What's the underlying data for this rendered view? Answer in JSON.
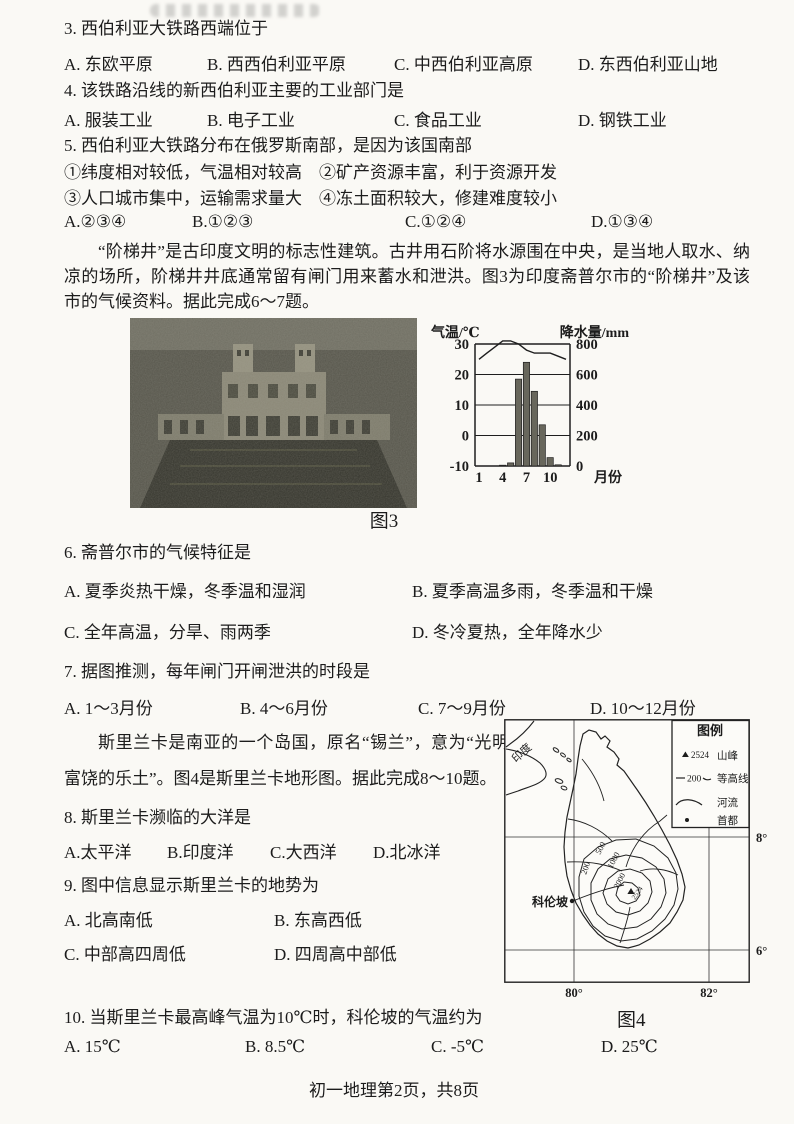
{
  "page": {
    "footer": "初一地理第2页，共8页"
  },
  "q3": {
    "stem": "3. 西伯利亚大铁路西端位于",
    "options": [
      "A. 东欧平原",
      "B. 西西伯利亚平原",
      "C. 中西伯利亚高原",
      "D. 东西伯利亚山地"
    ]
  },
  "q4": {
    "stem": "4. 该铁路沿线的新西伯利亚主要的工业部门是",
    "options": [
      "A. 服装工业",
      "B. 电子工业",
      "C. 食品工业",
      "D. 钢铁工业"
    ]
  },
  "q5": {
    "stem": "5. 西伯利亚大铁路分布在俄罗斯南部，是因为该国南部",
    "line1": "①纬度相对较低，气温相对较高　②矿产资源丰富，利于资源开发",
    "line2": "③人口城市集中，运输需求量大　④冻土面积较大，修建难度较小",
    "options": [
      "A.②③④",
      "B.①②③",
      "C.①②④",
      "D.①③④"
    ]
  },
  "passage1": "“阶梯井”是古印度文明的标志性建筑。古井用石阶将水源围在中央，是当地人取水、纳凉的场所，阶梯井井底通常留有闸门用来蓄水和泄洪。图3为印度斋普尔市的“阶梯井”及该市的气候资料。据此完成6～7题。",
  "figure3": {
    "caption": "图3"
  },
  "q6": {
    "stem": "6. 斋普尔市的气候特征是",
    "options": [
      "A. 夏季炎热干燥，冬季温和湿润",
      "B. 夏季高温多雨，冬季温和干燥",
      "C. 全年高温，分旱、雨两季",
      "D. 冬冷夏热，全年降水少"
    ]
  },
  "q7": {
    "stem": "7. 据图推测，每年闸门开闸泄洪的时段是",
    "options": [
      "A. 1～3月份",
      "B. 4～6月份",
      "C. 7～9月份",
      "D. 10～12月份"
    ]
  },
  "passage2": "斯里兰卡是南亚的一个岛国，原名“锡兰”，意为“光明富饶的乐土”。图4是斯里兰卡地形图。据此完成8～10题。",
  "q8": {
    "stem": "8. 斯里兰卡濒临的大洋是",
    "options": [
      "A.太平洋",
      "B.印度洋",
      "C.大西洋",
      "D.北冰洋"
    ]
  },
  "q9": {
    "stem": "9. 图中信息显示斯里兰卡的地势为",
    "options": [
      "A. 北高南低",
      "B. 东高西低",
      "C. 中部高四周低",
      "D. 四周高中部低"
    ]
  },
  "q10": {
    "stem": "10. 当斯里兰卡最高峰气温为10℃时，科伦坡的气温约为",
    "options": [
      "A. 15℃",
      "B. 8.5℃",
      "C. -5℃",
      "D. 25℃"
    ]
  },
  "figure4": {
    "caption": "图4",
    "legend": {
      "title": "图例",
      "peak_value": "2524",
      "peak_label": "山峰",
      "contour_value": "200",
      "contour_label": "等高线",
      "river_label": "河流",
      "capital_label": "首都"
    },
    "country_label": "印度",
    "capital_name": "科伦坡",
    "contour_labels": [
      "200",
      "500",
      "1000",
      "2000"
    ],
    "lat_labels": [
      "8°",
      "6°"
    ],
    "lon_labels": [
      "80°",
      "82°"
    ]
  },
  "chart_data": {
    "type": "bar",
    "title": "斋普尔市气候资料（图3）",
    "x": [
      1,
      2,
      3,
      4,
      5,
      6,
      7,
      8,
      9,
      10,
      11,
      12
    ],
    "xlabel": "月份",
    "x_ticks_shown": [
      1,
      4,
      7,
      10
    ],
    "series": [
      {
        "name": "降水量/mm",
        "type": "bar",
        "axis": "right",
        "values": [
          3,
          3,
          3,
          5,
          20,
          570,
          680,
          490,
          270,
          55,
          8,
          3
        ]
      },
      {
        "name": "气温/℃",
        "type": "line",
        "axis": "left",
        "values": [
          25,
          27,
          29,
          31,
          31,
          30,
          28,
          27,
          27,
          27,
          26,
          25
        ]
      }
    ],
    "left_axis": {
      "label": "气温/℃",
      "ticks": [
        30,
        20,
        10,
        0,
        -10
      ],
      "range": [
        -10,
        30
      ]
    },
    "right_axis": {
      "label": "降水量/mm",
      "ticks": [
        800,
        600,
        400,
        200,
        0
      ],
      "range": [
        0,
        800
      ]
    },
    "grid": true,
    "legend_position": "none"
  }
}
